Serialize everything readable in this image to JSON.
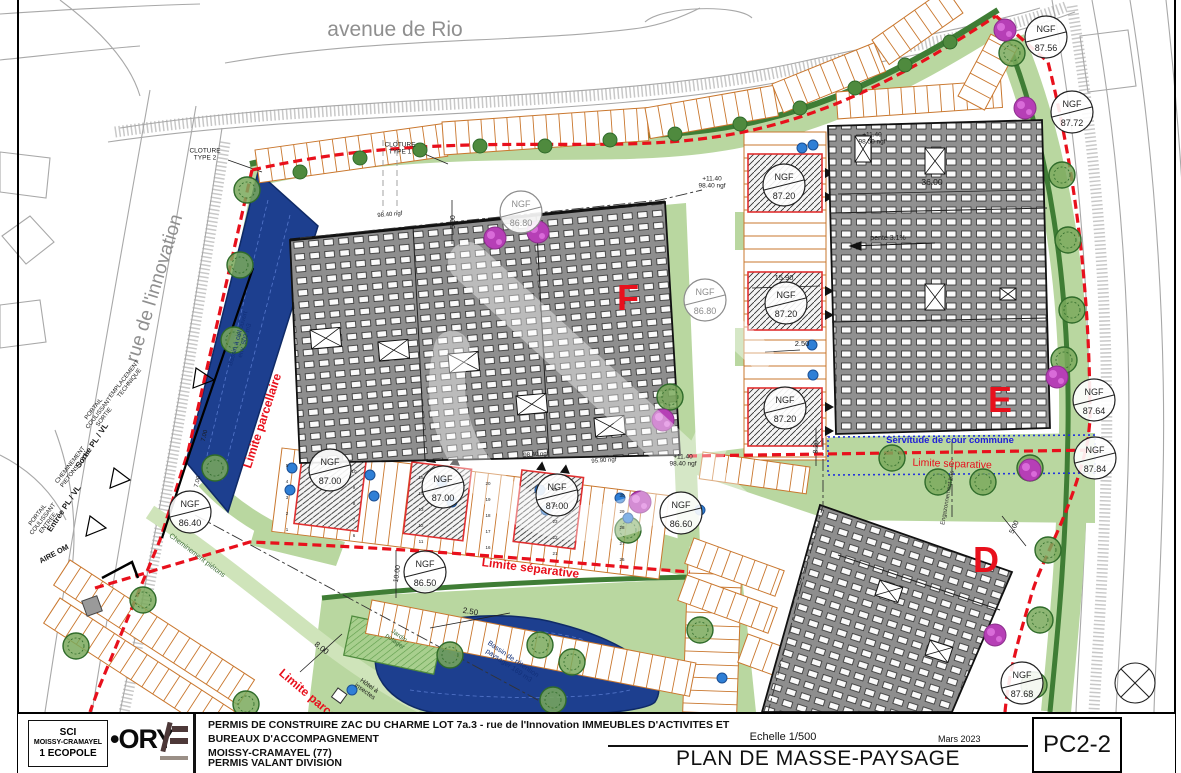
{
  "title_block": {
    "project_line1": "PERMIS DE CONSTRUIRE ZAC DU CHARME LOT 7a.3 - rue de l'Innovation IMMEUBLES D'ACTIVITES ET BUREAUX D'ACCOMPAGNEMENT",
    "project_line2": "MOISSY-CRAMAYEL (77)",
    "project_line3": "PERMIS VALANT DIVISION",
    "scale": "Echelle 1/500",
    "title": "PLAN DE MASSE-PAYSAGE",
    "date": "Mars 2023",
    "sheet_number": "PC2-2"
  },
  "client_box": {
    "line1": "SCI",
    "line2": "MOISSY-CRAMAYEL",
    "line3": "1 ECOPOLE"
  },
  "logos": {
    "ory": "•ORY"
  },
  "map": {
    "ngf_label": "NGF",
    "ngf_markers": [
      {
        "v": "87.56",
        "x": 1046,
        "y": 37
      },
      {
        "v": "87.72",
        "x": 1072,
        "y": 112
      },
      {
        "v": "86.80",
        "x": 521,
        "y": 212,
        "gray": true
      },
      {
        "v": "86.80",
        "x": 705,
        "y": 300,
        "gray": true
      },
      {
        "v": "87.20",
        "x": 784,
        "y": 185
      },
      {
        "v": "87.20",
        "x": 786,
        "y": 303
      },
      {
        "v": "87.20",
        "x": 785,
        "y": 408
      },
      {
        "v": "87.64",
        "x": 1094,
        "y": 400
      },
      {
        "v": "87.84",
        "x": 1095,
        "y": 458
      },
      {
        "v": "86.40",
        "x": 190,
        "y": 512
      },
      {
        "v": "87.00",
        "x": 330,
        "y": 470
      },
      {
        "v": "87.00",
        "x": 443,
        "y": 487
      },
      {
        "v": "87.00",
        "x": 557,
        "y": 495
      },
      {
        "v": "86.50",
        "x": 425,
        "y": 572
      },
      {
        "v": "86.60",
        "x": 681,
        "y": 513
      },
      {
        "v": "87.68",
        "x": 1022,
        "y": 683
      }
    ],
    "labels": [
      {
        "t": "avenue de Rio",
        "x": 395,
        "y": 36,
        "s": 21,
        "c": "#8f8f8f"
      },
      {
        "t": "rue de l'innovation",
        "x": 160,
        "y": 290,
        "s": 19,
        "r": -73,
        "c": "#8f8f8f"
      },
      {
        "t": "CLOTURE\nTYPE 2",
        "x": 205,
        "y": 156,
        "s": 6.5
      },
      {
        "t": "CLOTURE\nTYPE 1",
        "x": 400,
        "y": 150,
        "s": 6.5
      },
      {
        "t": "+11.40\n98.40 ngf",
        "x": 712,
        "y": 184,
        "s": 6.5
      },
      {
        "t": "+11.40\n98.40 ngf",
        "x": 683,
        "y": 462,
        "s": 6.5
      },
      {
        "t": "+11.40\n98.50 ngf",
        "x": 872,
        "y": 140,
        "s": 6.5
      },
      {
        "t": "pente 3.1%",
        "x": 888,
        "y": 240,
        "s": 7
      },
      {
        "t": "36.00",
        "x": 932,
        "y": 185,
        "s": 8.5
      },
      {
        "t": "15.90",
        "x": 784,
        "y": 280,
        "s": 7.5
      },
      {
        "t": "2.50",
        "x": 802,
        "y": 346,
        "s": 7.5
      },
      {
        "t": "2.50",
        "x": 470,
        "y": 614,
        "s": 8,
        "r": 10
      },
      {
        "t": "8.00",
        "x": 320,
        "y": 650,
        "s": 8,
        "r": 38
      },
      {
        "t": "10.00",
        "x": 399,
        "y": 574,
        "s": 7,
        "r": -82
      },
      {
        "t": "5.00",
        "x": 455,
        "y": 222,
        "s": 7,
        "r": -90
      },
      {
        "t": "5.00",
        "x": 1016,
        "y": 528,
        "s": 7,
        "r": -65
      },
      {
        "t": "8.20",
        "x": 818,
        "y": 447,
        "s": 7,
        "r": -87
      },
      {
        "t": "7.00",
        "x": 206,
        "y": 436,
        "s": 6,
        "r": -76
      },
      {
        "t": "7.00",
        "x": 199,
        "y": 482,
        "s": 6,
        "r": -76
      },
      {
        "t": "Limite parcellaire",
        "x": 266,
        "y": 422,
        "s": 12,
        "r": -72,
        "c": "#e8101c",
        "b": true
      },
      {
        "t": "Limite parcellaire",
        "x": 316,
        "y": 706,
        "s": 12,
        "r": 40,
        "c": "#e8101c",
        "b": true
      },
      {
        "t": "Limite séparative",
        "x": 530,
        "y": 572,
        "s": 12,
        "r": 7,
        "c": "#e8101c",
        "b": true
      },
      {
        "t": "Limite séparative",
        "x": 952,
        "y": 467,
        "s": 10.5,
        "r": 2,
        "c": "#e8101c"
      },
      {
        "t": "Servitude de cour commune",
        "x": 950,
        "y": 443,
        "s": 9.5,
        "c": "#2020d8",
        "b": true
      },
      {
        "t": "Cheminement piétons",
        "x": 196,
        "y": 557,
        "s": 7,
        "r": 37,
        "c": "#3a6b33"
      },
      {
        "t": "Jardin\npotager",
        "x": 396,
        "y": 640,
        "s": 6.5,
        "r": 36,
        "c": "#3a6b33"
      },
      {
        "t": "Hôtel à\ninsectes",
        "x": 366,
        "y": 690,
        "s": 6.5,
        "r": 36
      },
      {
        "t": "Bassin de rétention\npaysager 169 m3",
        "x": 510,
        "y": 664,
        "s": 7,
        "r": 34,
        "c": "#12307a"
      },
      {
        "t": "Bassin à ciel ouvert\nenv. 502 m3",
        "x": 243,
        "y": 340,
        "s": 6.5,
        "r": -74,
        "c": "#12307a"
      },
      {
        "t": "Sortie PL / VL",
        "x": 94,
        "y": 447,
        "s": 8,
        "r": -56,
        "b": true
      },
      {
        "t": "Entrée PL / VL",
        "x": 66,
        "y": 510,
        "s": 8,
        "r": -56,
        "b": true
      },
      {
        "t": "EMPLACEMENT\nTECHNIQUE",
        "x": 128,
        "y": 382,
        "s": 6,
        "r": -52
      },
      {
        "t": "PORTAIL\nCOULISSANT\nSORTIE",
        "x": 100,
        "y": 414,
        "s": 6,
        "r": -52
      },
      {
        "t": "PORTAIL\nCOULISSANT\nENTREE",
        "x": 44,
        "y": 520,
        "s": 6,
        "r": -52
      },
      {
        "t": "CHEMINEMENT\nPIETONS 1.20m",
        "x": 74,
        "y": 468,
        "s": 6,
        "r": -52
      },
      {
        "t": "AIRE OM",
        "x": 55,
        "y": 556,
        "s": 7.5,
        "r": -28,
        "b": true
      },
      {
        "t": "Engazonnement bas",
        "x": 949,
        "y": 498,
        "s": 6,
        "r": -80,
        "c": "#333"
      },
      {
        "t": "98.40 ngf",
        "x": 390,
        "y": 216,
        "s": 6,
        "r": -5
      },
      {
        "t": "98.40 ngf",
        "x": 536,
        "y": 456,
        "s": 6,
        "r": -4
      },
      {
        "t": "95.90 ngf",
        "x": 604,
        "y": 462,
        "s": 6,
        "r": -4
      },
      {
        "t": "F",
        "x": 628,
        "y": 310,
        "s": 36,
        "c": "#e8101c",
        "b": true
      },
      {
        "t": "E",
        "x": 1000,
        "y": 412,
        "s": 36,
        "c": "#e8101c",
        "b": true
      },
      {
        "t": "D",
        "x": 986,
        "y": 572,
        "s": 36,
        "c": "#e8101c",
        "b": true
      }
    ],
    "stall_numbers": {
      "south_row": [
        1,
        2,
        3,
        4,
        5,
        6,
        7,
        8,
        9,
        10,
        11,
        12,
        13,
        14,
        15,
        16,
        17,
        18,
        19,
        20,
        21,
        22,
        23,
        24,
        25,
        26,
        27,
        28,
        29,
        30
      ]
    }
  }
}
